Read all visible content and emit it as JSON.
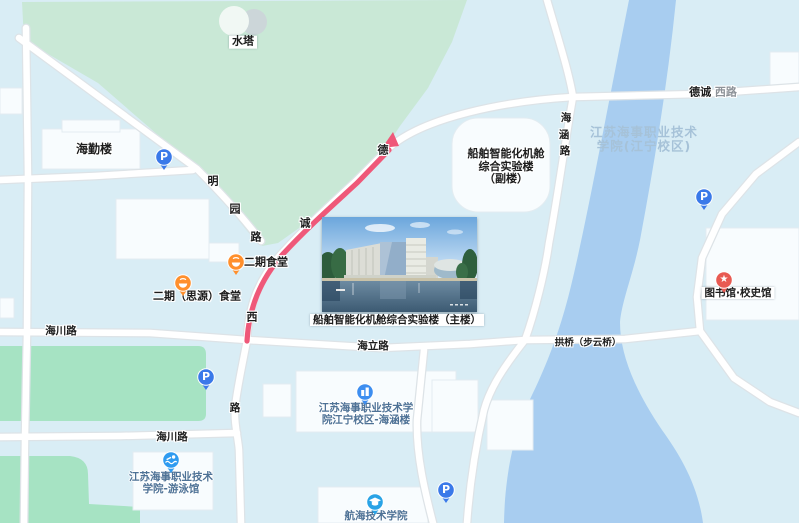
{
  "labels": {
    "water_tower": "水塔",
    "haiqin_building": "海勤楼",
    "canteen_phase2": "二期食堂",
    "canteen_siyuan": "二期（思源）食堂",
    "annex_line1": "船舶智能化机舱",
    "annex_line2": "综合实验楼",
    "annex_line3": "（副楼）",
    "main_building": "船舶智能化机舱综合实验楼（主楼）",
    "library": "图书馆·校史馆",
    "bridge": "拱桥（步云桥）",
    "haihan_poi_line1": "江苏海事职业技术学",
    "haihan_poi_line2": "院江宁校区-海涵楼",
    "swimming_line1": "江苏海事职业技术",
    "swimming_line2": "学院-游泳馆",
    "navigation_college": "航海技术学院",
    "watermark_line1": "江苏海事职业技术",
    "watermark_line2": "学院(江宁校区)"
  },
  "roads": {
    "decheng_bold": "德诚",
    "decheng_suffix": "西路",
    "mingyuan": [
      "明",
      "园",
      "路"
    ],
    "route_chars": [
      "德",
      "诚",
      "西"
    ],
    "haihan_road": [
      "海",
      "涵",
      "路"
    ],
    "haili": "海立路",
    "haichuan_upper": "海川路",
    "haichuan_lower": "海川路",
    "lu_char": "路"
  },
  "icons": {
    "parking_letter": "P",
    "parking": "parking-pin",
    "food": "restaurant-pin",
    "library": "landmark-star-pin",
    "campus_building": "building-pin",
    "swimming": "swimmer-pin",
    "college": "graduation-cap-pin"
  },
  "colors": {
    "base": "#d9edf5",
    "park": "#c9e8d6",
    "field": "#a6e3c3",
    "river": "#a8cdf0",
    "road": "#ffffff",
    "route": "#ef5879",
    "parking_blue": "#3a79e9",
    "food_orange": "#ff8f2c",
    "library_red": "#e85a52",
    "poi_blue": "#2f9bf0"
  }
}
